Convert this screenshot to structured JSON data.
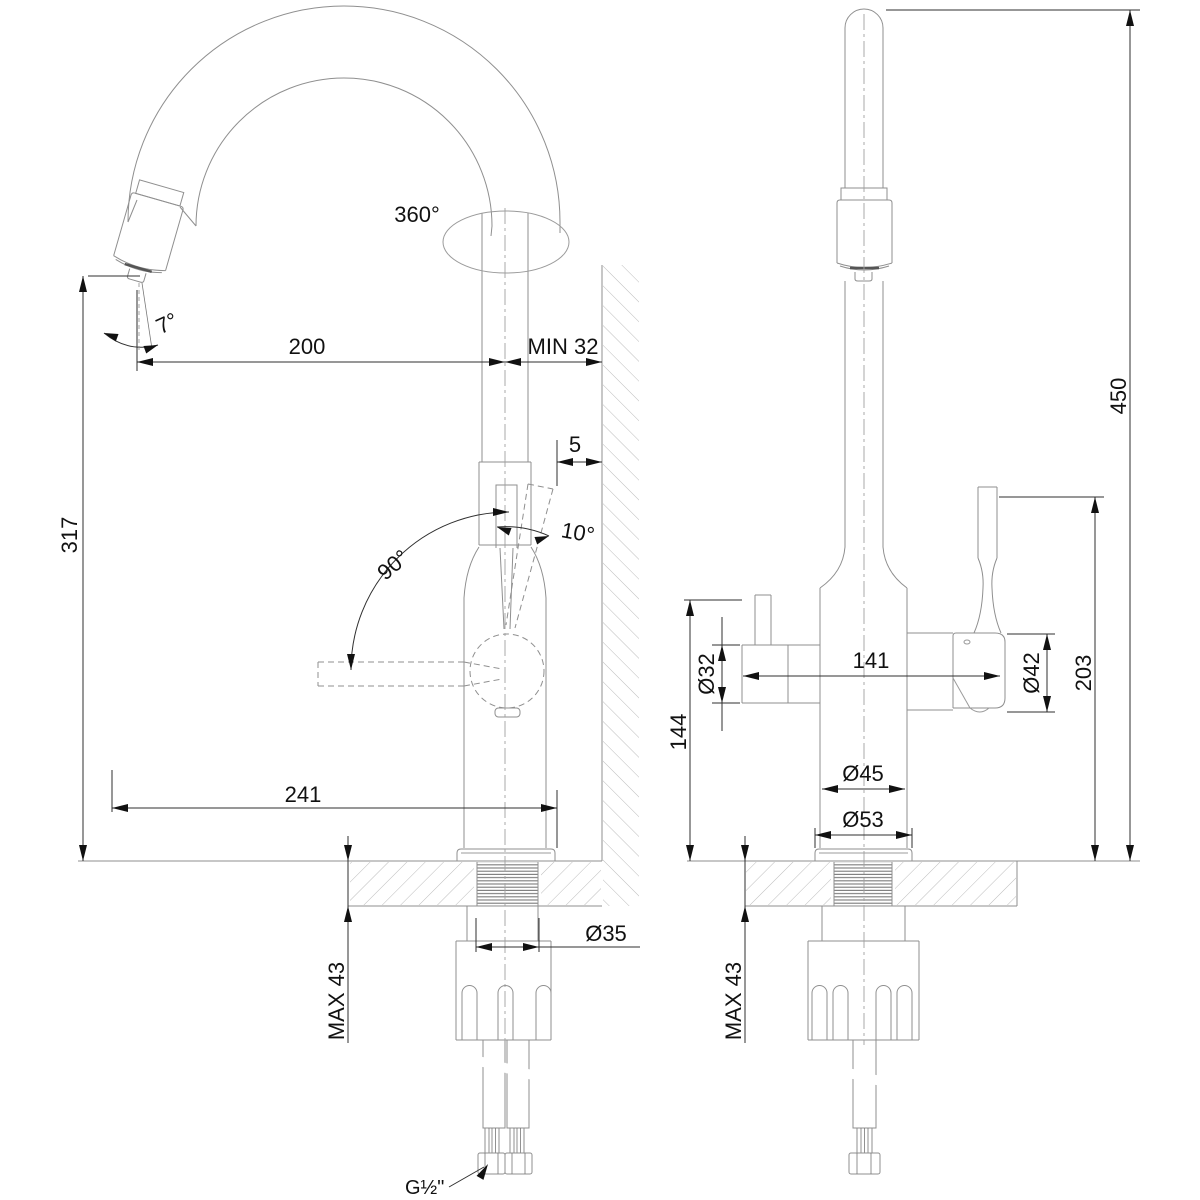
{
  "side_view": {
    "labels": {
      "swivel": "360°",
      "spray_angle": "7°",
      "reach": "200",
      "min_wall_clearance": "MIN 32",
      "wall_gap": "5",
      "handle_tilt": "10°",
      "handle_swing": "90°",
      "spout_height": "317",
      "overall_reach": "241",
      "max_deck_thickness": "MAX 43",
      "shank_diameter": "Ø35",
      "hose_thread": "G½\""
    }
  },
  "front_view": {
    "labels": {
      "overall_height": "450",
      "side_valve_diameter": "Ø32",
      "body_width": "141",
      "mixer_valve_diameter": "Ø42",
      "handle_top_height": "203",
      "side_handle_height": "144",
      "body_diameter": "Ø45",
      "base_diameter": "Ø53",
      "max_deck_thickness": "MAX 43"
    }
  },
  "colors": {
    "geometry_line": "#8f8f8f",
    "dimension_line": "#2f2f2f",
    "text": "#111111",
    "hatch": "#b5b5b5",
    "background": "#ffffff"
  }
}
